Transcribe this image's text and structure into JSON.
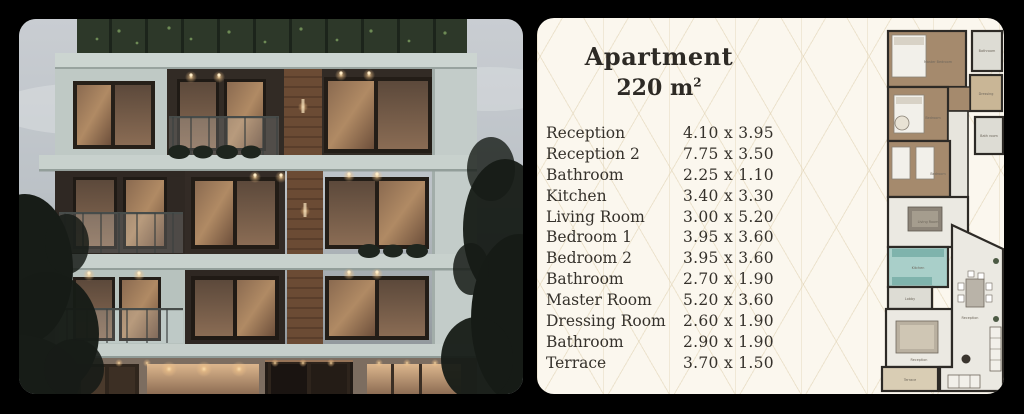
{
  "scene": {
    "background": "#000000"
  },
  "building_card": {
    "description": "building-exterior-render"
  },
  "spec_card": {
    "background": "#fbf7ee",
    "pattern_line_color": "#decfae",
    "text_color": "#35312b",
    "title_line1": "Apartment",
    "title_area_value": "220 m",
    "title_area_sup": "2",
    "rooms": [
      {
        "name": "Reception",
        "size": "4.10 x 3.95"
      },
      {
        "name": "Reception 2",
        "size": "7.75 x 3.50"
      },
      {
        "name": "Bathroom",
        "size": "2.25 x 1.10"
      },
      {
        "name": "Kitchen",
        "size": "3.40 x 3.30"
      },
      {
        "name": "Living Room",
        "size": "3.00 x 5.20"
      },
      {
        "name": "Bedroom 1",
        "size": "3.95 x 3.60"
      },
      {
        "name": "Bedroom 2",
        "size": "3.95 x 3.60"
      },
      {
        "name": "Bathroom",
        "size": "2.70 x 1.90"
      },
      {
        "name": "Master Room",
        "size": "5.20 x 3.60"
      },
      {
        "name": "Dressing Room",
        "size": "2.60 x 1.90"
      },
      {
        "name": "Bathroom",
        "size": "2.90 x 1.90"
      },
      {
        "name": "Terrace",
        "size": "3.70 x 1.50"
      }
    ],
    "floor_plan": {
      "wall_color": "#2d2a26",
      "wood_floor_color": "#a58a6d",
      "tile_color": "#dddcd4",
      "kitchen_color": "#a9cfc9",
      "terrace_color": "#d9cdb4",
      "labels": [
        "Master Bedroom",
        "Bathroom",
        "Dressing",
        "Bedroom",
        "Bath room",
        "Bedroom",
        "Living Room",
        "Kitchen",
        "Lobby",
        "Reception",
        "Reception",
        "Terrace"
      ]
    }
  }
}
